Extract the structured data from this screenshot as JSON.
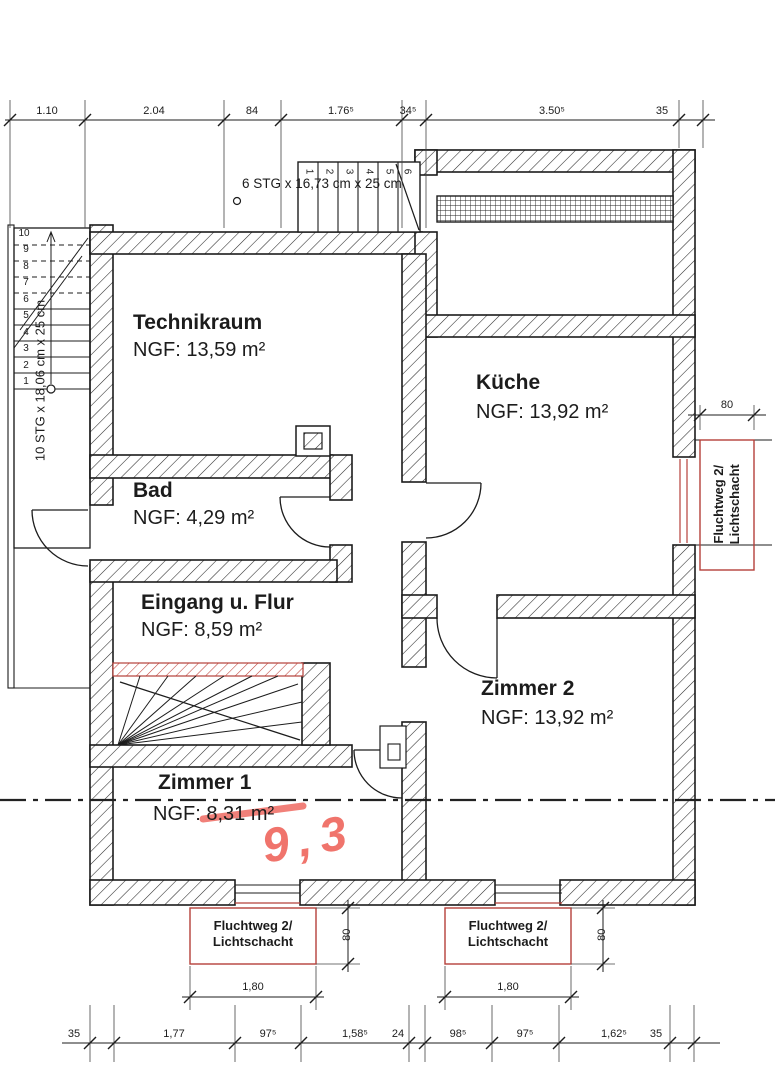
{
  "plan": {
    "rooms": [
      {
        "name": "Technikraum",
        "area": "NGF: 13,59 m²"
      },
      {
        "name": "Küche",
        "area": "NGF: 13,92 m²"
      },
      {
        "name": "Bad",
        "area": "NGF: 4,29 m²"
      },
      {
        "name": "Eingang u. Flur",
        "area": "NGF: 8,59 m²"
      },
      {
        "name": "Zimmer 2",
        "area": "NGF: 13,92 m²"
      },
      {
        "name": "Zimmer 1",
        "area": "NGF: 8,31 m²"
      }
    ],
    "stairs": {
      "top": {
        "label": "6 STG x 16,73 cm x 25 cm",
        "steps": [
          "1",
          "2",
          "3",
          "4",
          "5",
          "6"
        ]
      },
      "left": {
        "label": "10 STG x 18,06 cm x 25 cm",
        "steps": [
          "1",
          "2",
          "3",
          "4",
          "5",
          "6",
          "7",
          "8",
          "9",
          "10"
        ]
      }
    },
    "escape_route": {
      "line1": "Fluchtweg 2/",
      "line2": "Lichtschacht"
    },
    "dimensions": {
      "top_chain": [
        "1.10",
        "2.04",
        "84",
        "1.76⁵",
        "34⁵",
        "3.50⁵",
        "35"
      ],
      "bottom_chain": [
        "35",
        "1,77",
        "97⁵",
        "1,58⁵",
        "24",
        "98⁵",
        "97⁵",
        "1,62⁵",
        "35"
      ],
      "lightshaft_width": "1,80",
      "lightshaft_depth": "80"
    },
    "annotations": {
      "handwritten_area": "9,3"
    },
    "colors": {
      "line": "#1c1c1c",
      "escape_red": "#b5403a",
      "marker_red": "#ee6158"
    }
  }
}
